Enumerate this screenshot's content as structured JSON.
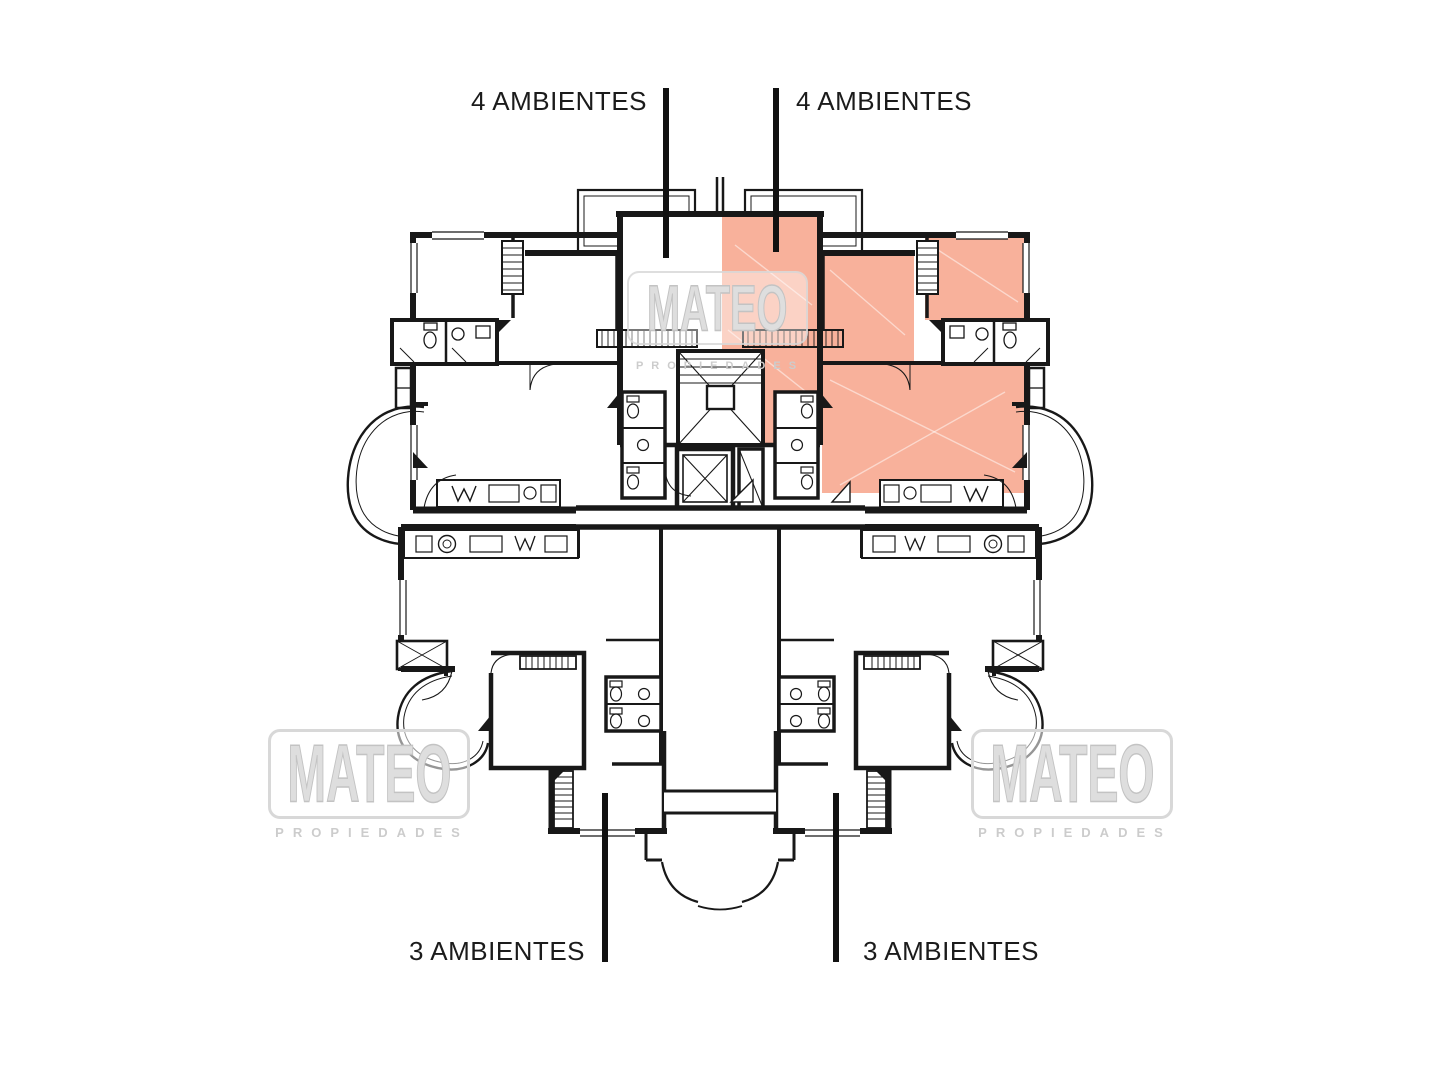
{
  "page": {
    "type": "architectural-floor-plan",
    "background": "#ffffff"
  },
  "labels": {
    "top_left": "4 AMBIENTES",
    "top_right": "4 AMBIENTES",
    "bottom_left": "3 AMBIENTES",
    "bottom_right": "3 AMBIENTES"
  },
  "watermark": {
    "name": "MATEO",
    "subtitle": "PROPIEDADES"
  },
  "highlight": {
    "color": "#f8b19b",
    "unit_label": "4 AMBIENTES",
    "position": "top-right unit"
  },
  "colors": {
    "walls": "#181818",
    "label_text": "#1b1b1b",
    "watermark_gray": "#cfcfcf"
  }
}
